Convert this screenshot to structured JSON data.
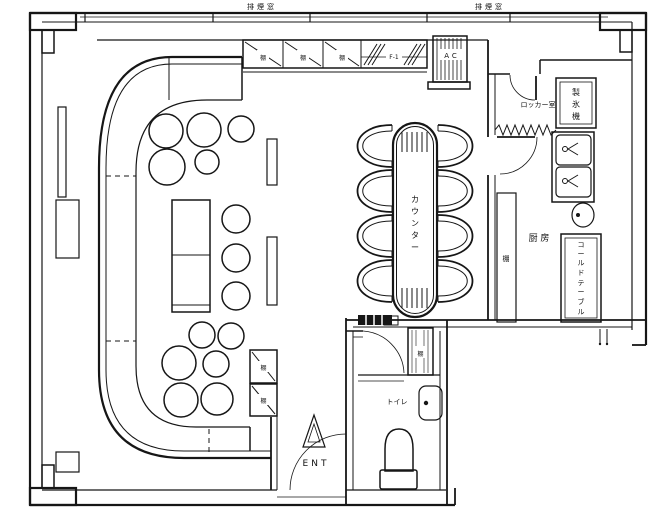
{
  "plan": {
    "vent_left": "排煙窓",
    "vent_right": "排煙窓",
    "shelf_char": "棚",
    "fixture_code": "F-1",
    "ac": "AC",
    "locker_room": "ロッカー室",
    "ice": [
      "製",
      "氷",
      "機"
    ],
    "kitchen": "厨 房",
    "kitchen_shelf": "棚",
    "cold_table": [
      "コ",
      "ー",
      "ル",
      "ド",
      "テ",
      "ー",
      "ブ",
      "ル"
    ],
    "counter": [
      "カ",
      "ウ",
      "ン",
      "タ",
      "ー"
    ],
    "toilet": "トイレ",
    "toilet_shelf": "棚",
    "ent": "ENT"
  },
  "colors": {
    "ink": "#161616",
    "paper": "#ffffff"
  }
}
